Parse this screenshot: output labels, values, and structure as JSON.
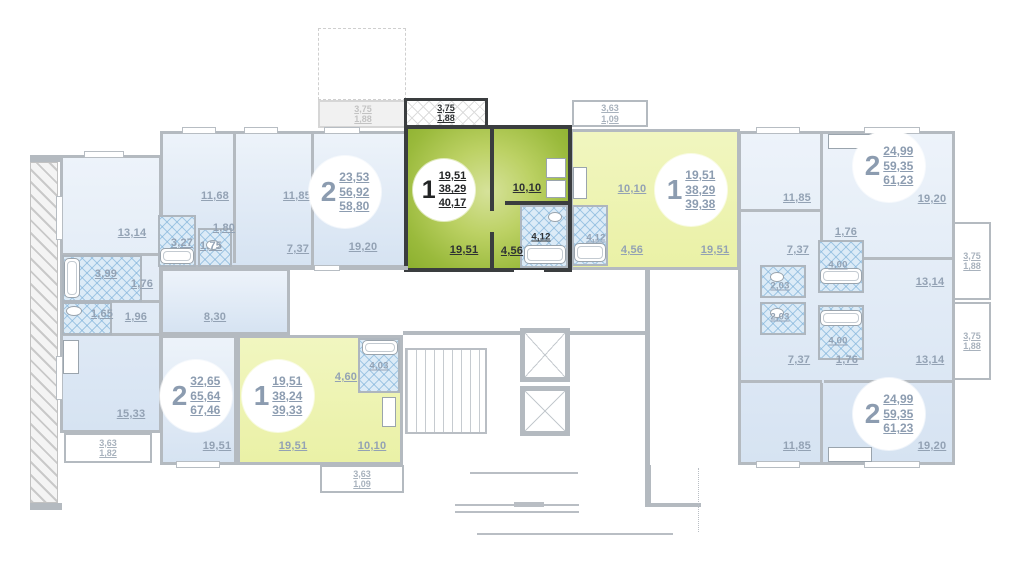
{
  "badges": [
    {
      "num": "2",
      "a": [
        "23,53",
        "56,92",
        "58,80"
      ]
    },
    {
      "num": "1",
      "a": [
        "19,51",
        "38,29",
        "40,17"
      ]
    },
    {
      "num": "1",
      "a": [
        "19,51",
        "38,29",
        "39,38"
      ]
    },
    {
      "num": "2",
      "a": [
        "24,99",
        "59,35",
        "61,23"
      ]
    },
    {
      "num": "2",
      "a": [
        "24,99",
        "59,35",
        "61,23"
      ]
    },
    {
      "num": "2",
      "a": [
        "32,65",
        "65,64",
        "67,46"
      ]
    },
    {
      "num": "1",
      "a": [
        "19,51",
        "38,24",
        "39,33"
      ]
    }
  ],
  "rooms": {
    "left_1314": "13,14",
    "left_399": "3,99",
    "left_176": "1,76",
    "left_165": "1,65",
    "left_196": "1,96",
    "left_1533": "15,33",
    "tl_1168": "11,68",
    "tl_1185": "11,85",
    "tl_327": "3,27",
    "tl_175": "1,75",
    "tl_180": "1,80",
    "tl_737": "7,37",
    "tl_1920": "19,20",
    "tl_830": "8,30",
    "sel_1951": "19,51",
    "sel_1010": "10,10",
    "sel_412": "4,12",
    "sel_456": "4,56",
    "mid_1010": "10,10",
    "mid_412": "4,12",
    "mid_456": "4,56",
    "mid_1951": "19,51",
    "tr_1185": "11,85",
    "tr_1920": "19,20",
    "tr_176": "1,76",
    "tr_737": "7,37",
    "tr_400": "4,00",
    "tr_203": "2,03",
    "tr_1314": "13,14",
    "br_203": "2,03",
    "br_400": "4,00",
    "br_737": "7,37",
    "br_176": "1,76",
    "br_1314": "13,14",
    "br_1185": "11,85",
    "br_1920": "19,20",
    "bl_1951": "19,51",
    "b1_1951": "19,51",
    "b1_460": "4,60",
    "b1_403": "4,03",
    "b1_1010": "10,10"
  },
  "balconies": {
    "left": {
      "l1": "3,63",
      "l2": "1,82"
    },
    "top_gray": {
      "l1": "3,75",
      "l2": "1,88"
    },
    "top_selected": {
      "l1": "3,75",
      "l2": "1,88"
    },
    "top_mid": {
      "l1": "3,63",
      "l2": "1,09"
    },
    "right_top": {
      "l1": "3,75",
      "l2": "1,88"
    },
    "right_bottom": {
      "l1": "3,75",
      "l2": "1,88"
    },
    "bottom": {
      "l1": "3,63",
      "l2": "1,09"
    }
  }
}
